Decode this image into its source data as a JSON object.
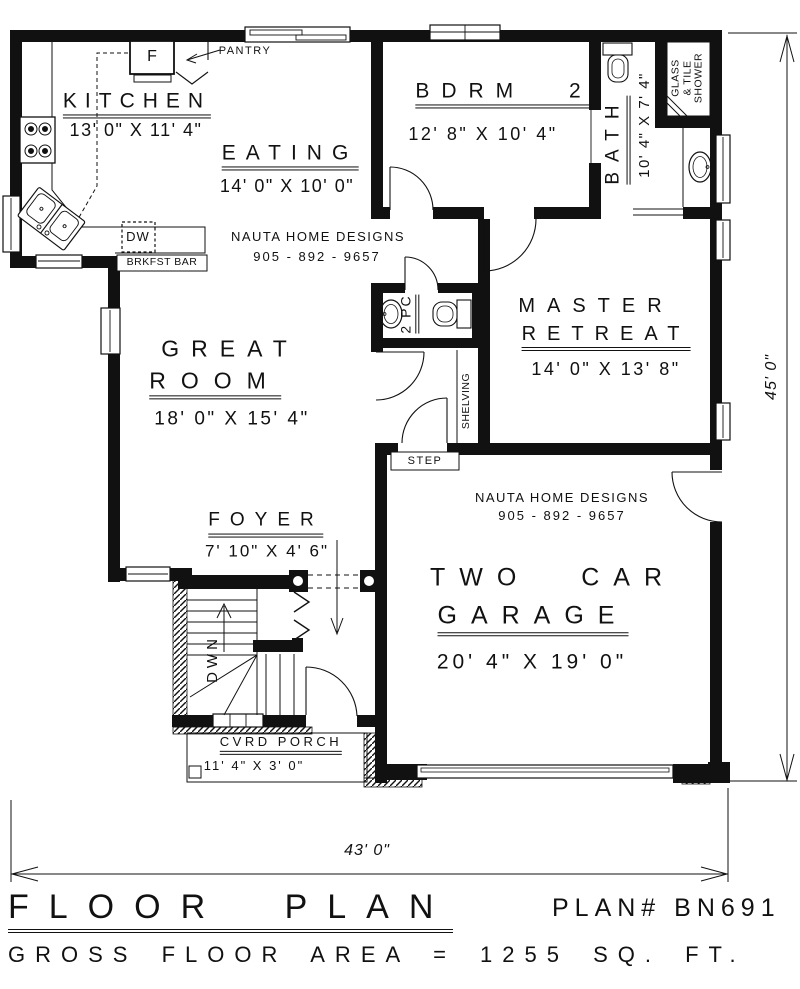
{
  "plan": {
    "rooms": {
      "kitchen": {
        "name": "KITCHEN",
        "dims": "13' 0\" X 11' 4\""
      },
      "eating": {
        "name": "EATING",
        "dims": "14' 0\" X 10' 0\""
      },
      "bdrm2": {
        "name": "BDRM 2",
        "dims": "12' 8\" X 10' 4\""
      },
      "bath": {
        "name": "BATH",
        "dims": "10' 4\" X 7' 4\""
      },
      "great_room": {
        "name_line1": "GREAT",
        "name_line2": "ROOM",
        "dims": "18' 0\" X 15' 4\""
      },
      "master": {
        "name_line1": "MASTER",
        "name_line2": "RETREAT",
        "dims": "14' 0\" X 13' 8\""
      },
      "garage": {
        "name_line1": "TWO CAR",
        "name_line2": "GARAGE",
        "dims": "20' 4\" X 19' 0\""
      },
      "foyer": {
        "name": "FOYER",
        "dims": "7' 10\" X 4' 6\""
      },
      "porch": {
        "name": "CVRD PORCH",
        "dims": "11' 4\" X 3' 0\""
      },
      "powder": {
        "name": "2 PC"
      },
      "shower": {
        "line1": "GLASS",
        "line2": "& TILE",
        "line3": "SHOWER"
      }
    },
    "labels": {
      "pantry": "PANTRY",
      "fridge": "F",
      "dishwasher": "DW",
      "breakfast_bar": "BRKFST BAR",
      "step": "STEP",
      "shelving": "SHELVING",
      "stairs_down": "DWN"
    },
    "branding": {
      "name": "NAUTA HOME DESIGNS",
      "phone": "905 - 892 - 9657"
    },
    "dimensions": {
      "overall_width": "43' 0\"",
      "overall_depth": "45' 0\""
    },
    "footer": {
      "title": "FLOOR PLAN",
      "plan_number": "PLAN# BN691",
      "gross_area": "GROSS FLOOR AREA = 1255 SQ. FT."
    }
  }
}
